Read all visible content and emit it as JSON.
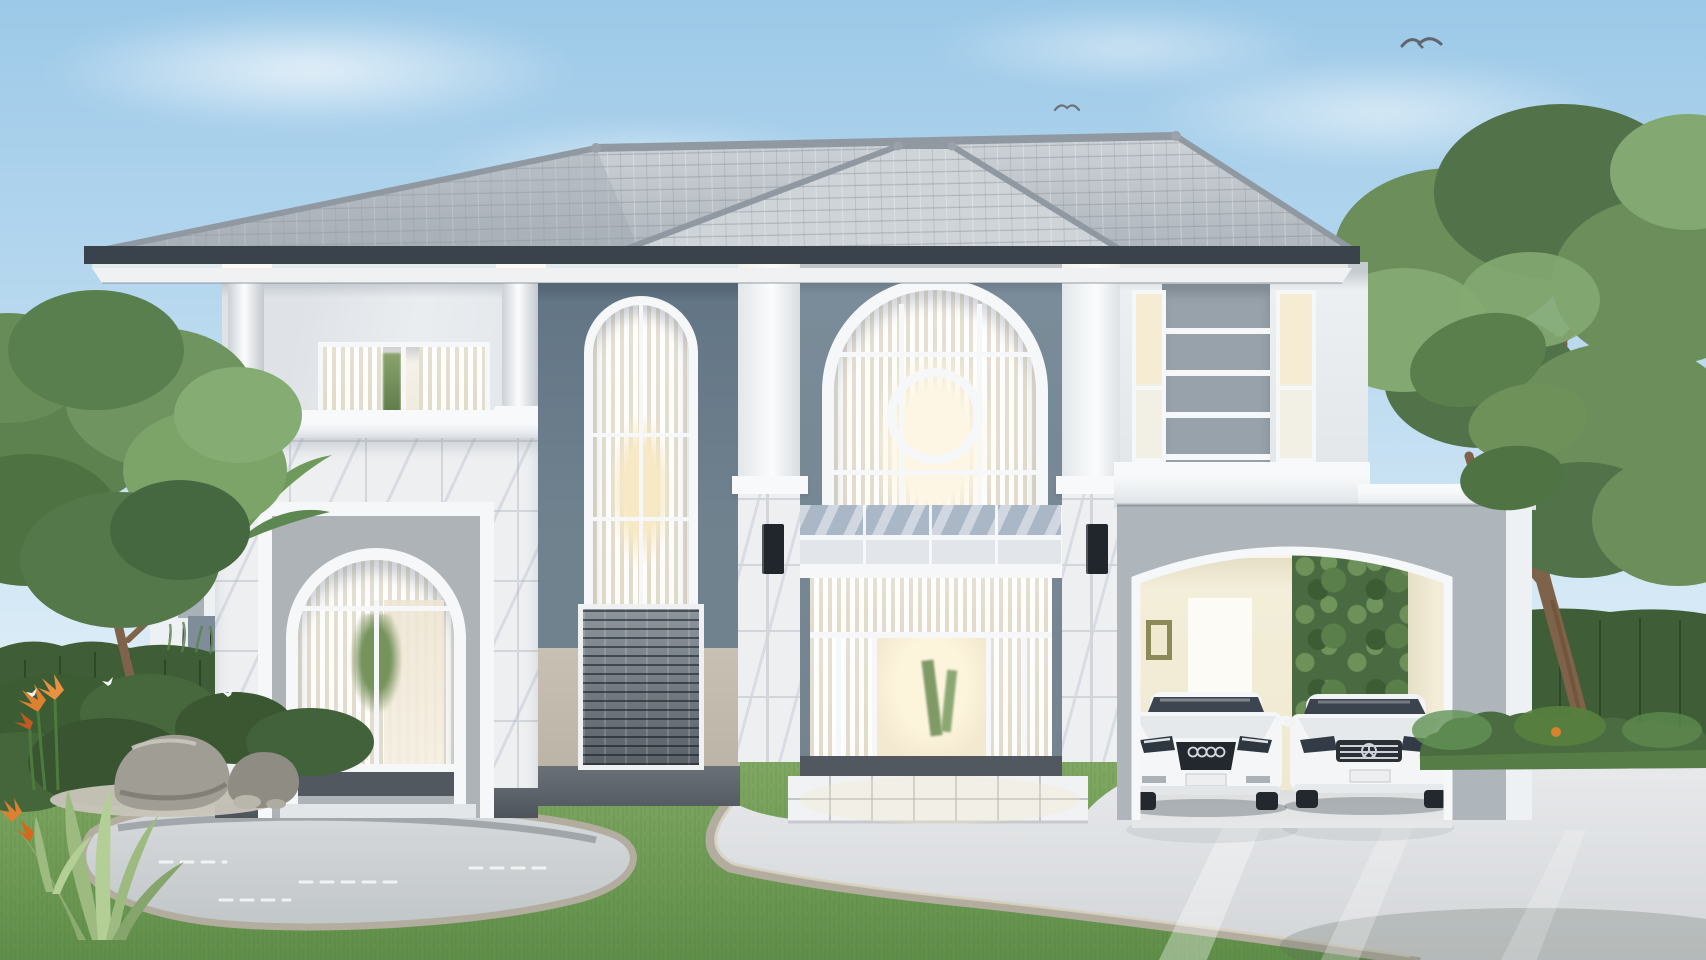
{
  "scene": {
    "domain": "natural-image",
    "subject": "Photorealistic 3D exterior rendering of a modern two-story luxury house",
    "setting": "daytime, pale blue sky, landscaped front yard with lawn, pond, rock garden and glossy driveway",
    "objects": [
      "sky",
      "clouds",
      "flying birds",
      "gray hip tile roof",
      "dark eave fascia",
      "left wing balcony porch with round columns",
      "balcony sliding window with plant",
      "marble tiled entry block",
      "arched entry with glass door and curtains",
      "tall arched stair window",
      "stacked stone veneer panels",
      "central double-height tower",
      "grand arched window with circle mullion",
      "marble balcony band",
      "glass entry doors with warm interior light",
      "black wall sconces",
      "right wing with gray louver panel and narrow windows",
      "carport with wide arched opening",
      "white Audi sedan",
      "white Mercedes sedan",
      "neighboring house behind trees",
      "garden hedges",
      "palm",
      "ornamental tree",
      "large sculptural tree",
      "rocks",
      "gravel patch",
      "agave plants",
      "bird of paradise flowers",
      "butterflies",
      "reflecting pond",
      "lawn",
      "stone-edged glossy driveway"
    ]
  },
  "palette": {
    "sky_top": "#9cc9e8",
    "sky_mid": "#c0ddf1",
    "sky_low": "#ddedf7",
    "cloud": "#ffffff",
    "roof_tile": "#bcc2c9",
    "roof_tile_light": "#cfd4d9",
    "roof_tile_dark": "#9ba3ac",
    "roof_ridge": "#9099a2",
    "roof_fascia": "#3a424c",
    "roof_soffit": "#eff1f3",
    "eave_glow": "#fdf9ec",
    "wall_white": "#e9ecef",
    "wall_white_bright": "#f7f9fa",
    "wall_slate": "#71828f",
    "wall_slate_dark": "#617484",
    "wall_beige": "#c8c0b3",
    "panel_gray": "#98a2aa",
    "carport_wall": "#aeb5bb",
    "carport_interior": "#f3eed9",
    "carport_interior_dark": "#e4dcc4",
    "olive_frame": "#8b8a58",
    "marble": "#edeff1",
    "marble_grid": "#d2d6db",
    "marble_vein": "#bac1cb",
    "marble_blue": "#a9b7c6",
    "stone_dark": "#565d64",
    "stone_light": "#959ca3",
    "frame_white": "#f5f7f9",
    "reveal_gray": "#aeb3b7",
    "curtain": "#f4f1e9",
    "curtain_shade": "#e1dbcb",
    "glow_warm": "#f7e9c6",
    "interior_warm": "#eee5d3",
    "interior_dark": "#49505a",
    "plinth": "#5f666e",
    "threshold": "#515860",
    "sconce": "#20262c",
    "grass": "#77a25b",
    "grass_dark": "#5f8c48",
    "grass_light": "#8bb26c",
    "hedge": "#3f5e37",
    "foliage": "#6b8e5a",
    "foliage_dark": "#527349",
    "foliage_light": "#84a871",
    "trunk": "#7e6249",
    "rock": "#a09d94",
    "rock_dark": "#75726a",
    "gravel": "#c9c5ba",
    "water": "#ccd1d4",
    "water_edge": "#b3ada0",
    "drive": "#e0e2e4",
    "drive_dark": "#d3d6d9",
    "car_white": "#f4f6f8",
    "car_shade": "#e2e6e9",
    "car_glass": "#3c4550",
    "car_dark": "#23282e",
    "chrome": "#cdd3d8",
    "flower_orange": "#dd8130"
  }
}
